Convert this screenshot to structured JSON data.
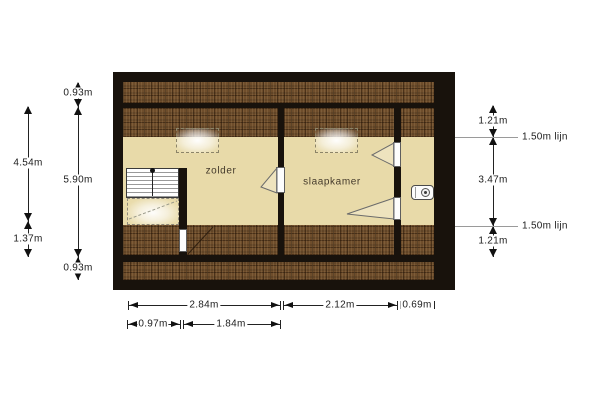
{
  "plan": {
    "rooms": [
      {
        "label": "zolder"
      },
      {
        "label": "slaapkamer"
      }
    ],
    "colors": {
      "wall": "#18120c",
      "floor": "#e8daa9",
      "roof_area": "#6e4d2b",
      "background": "#ffffff"
    }
  },
  "dimensions": {
    "left_outer": [
      {
        "label": "4.54m"
      },
      {
        "label": "1.37m"
      }
    ],
    "left_inner": [
      {
        "label": "0.93m"
      },
      {
        "label": "5.90m"
      },
      {
        "label": "0.93m"
      }
    ],
    "right": [
      {
        "label": "1.21m"
      },
      {
        "label": "3.47m"
      },
      {
        "label": "1.21m"
      }
    ],
    "height_lines": [
      {
        "label": "1.50m lijn"
      },
      {
        "label": "1.50m lijn"
      }
    ],
    "bottom_row1": [
      {
        "label": "2.84m"
      },
      {
        "label": "2.12m"
      },
      {
        "label": "0.69m"
      }
    ],
    "bottom_row2": [
      {
        "label": "0.97m"
      },
      {
        "label": "1.84m"
      }
    ]
  }
}
